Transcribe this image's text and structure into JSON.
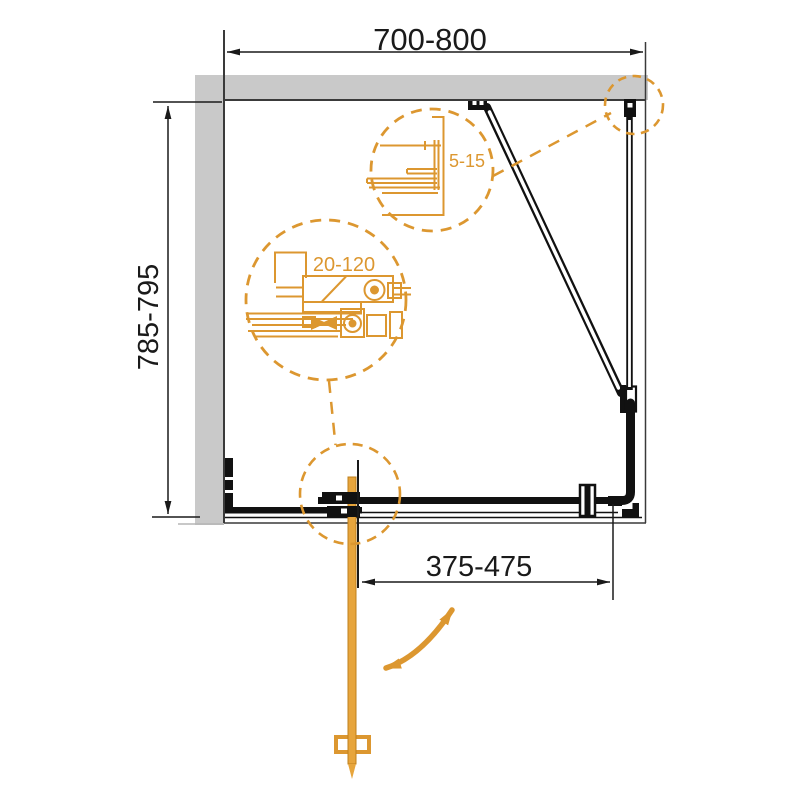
{
  "diagram": {
    "dimension_labels": {
      "width": "700-800",
      "depth": "785-795",
      "wall_gap": "5-15",
      "adjustment": "20-120",
      "door_opening": "375-475"
    },
    "colors": {
      "accent_orange": "#DC9730",
      "wall_gray": "#C9C9C9",
      "line_black": "#1A1A1A"
    }
  }
}
